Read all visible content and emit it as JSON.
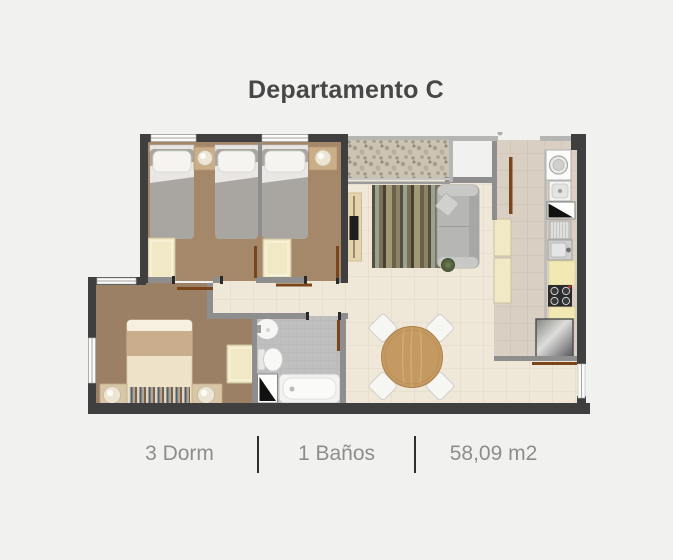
{
  "header": {
    "title": "Departamento C"
  },
  "stats": [
    "3 Dorm",
    "1 Baños",
    "58,09 m2"
  ],
  "theme": {
    "bg": "#f1f1ef",
    "title": "#474747",
    "stats": "#8d8d8d",
    "divider": "#2f2f2f",
    "wallDark": "#3f3f3f",
    "wallGray": "#8e8e8e",
    "wallLight": "#b5b5b3",
    "floorCream": "#efe8d8",
    "floorKitchen": "#d9cfc2",
    "floorBath": "#bfbfbf",
    "carpetA": "#a5876a",
    "carpetB": "#9c8065",
    "closet": "#f1e8c5",
    "counter": "#f2e8b4",
    "doorLeaf": "#7a451a",
    "wood": "#c49a62"
  }
}
